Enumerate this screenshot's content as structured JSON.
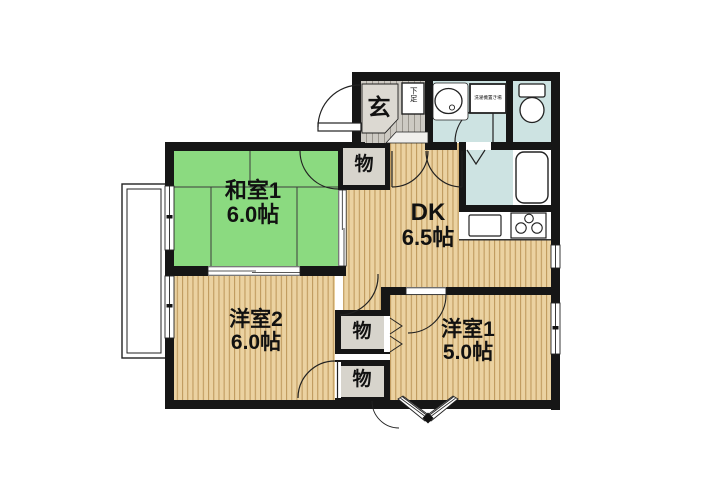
{
  "floorplan": {
    "rooms": {
      "washitsu1": {
        "label": "和室1",
        "area": "6.0帖"
      },
      "dk": {
        "label": "DK",
        "area": "6.5帖"
      },
      "youshitsu2": {
        "label": "洋室2",
        "area": "6.0帖"
      },
      "youshitsu1": {
        "label": "洋室1",
        "area": "5.0帖"
      }
    },
    "entry": {
      "label": "玄"
    },
    "shoe_box": {
      "label": "下足"
    },
    "laundry": {
      "label": "洗濯機置き場"
    },
    "closet": {
      "label": "物"
    },
    "colors": {
      "tatami": "#8bda80",
      "wood": "#ebd2a1",
      "wood_stripe": "#c09a5e",
      "water_area": "#cde3e2",
      "closet_fill": "#d7d4cc",
      "entry_floor": "#cdcac3",
      "wall": "#161616"
    }
  }
}
